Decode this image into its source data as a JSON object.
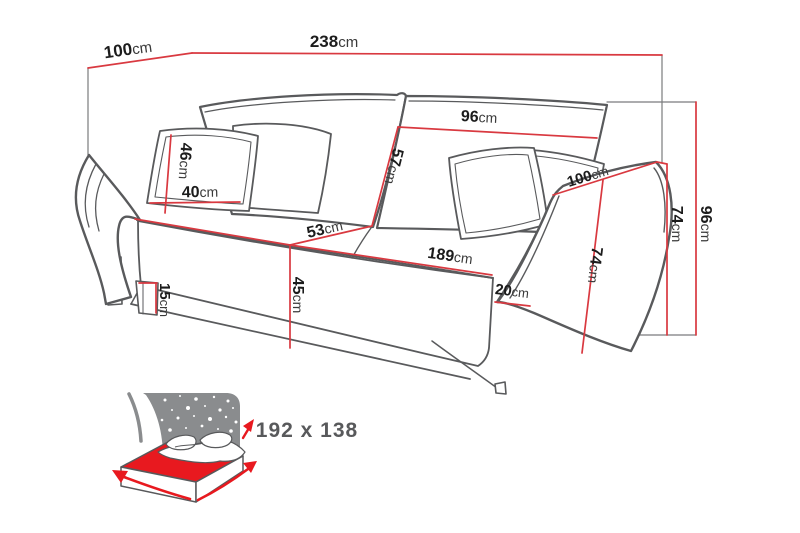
{
  "diagram": {
    "type": "sofa-bed dimension drawing",
    "unit_default": "cm",
    "dimensions": {
      "depth_top": {
        "value": "100",
        "unit": "cm",
        "meaning": "overall depth (top-left edge)"
      },
      "width_total": {
        "value": "238",
        "unit": "cm",
        "meaning": "overall width"
      },
      "back_cushion_width": {
        "value": "96",
        "unit": "cm",
        "meaning": "back cushion width"
      },
      "back_cushion_height": {
        "value": "57",
        "unit": "cm",
        "meaning": "back cushion height"
      },
      "pillow_height": {
        "value": "46",
        "unit": "cm",
        "meaning": "small pillow height"
      },
      "pillow_width": {
        "value": "40",
        "unit": "cm",
        "meaning": "small pillow width"
      },
      "seat_depth": {
        "value": "53",
        "unit": "cm",
        "meaning": "seat depth"
      },
      "seat_height": {
        "value": "45",
        "unit": "cm",
        "meaning": "seat height from floor"
      },
      "leg_height": {
        "value": "15",
        "unit": "cm",
        "meaning": "leg height"
      },
      "seat_width": {
        "value": "189",
        "unit": "cm",
        "meaning": "seat width between arms"
      },
      "arm_width": {
        "value": "20",
        "unit": "cm",
        "meaning": "armrest width"
      },
      "arm_depth": {
        "value": "100",
        "unit": "cm",
        "meaning": "armrest top depth"
      },
      "arm_height_front": {
        "value": "74",
        "unit": "cm",
        "meaning": "armrest height (front)"
      },
      "arm_height_back": {
        "value": "74",
        "unit": "cm",
        "meaning": "armrest height (back)"
      },
      "total_height": {
        "value": "96",
        "unit": "cm",
        "meaning": "total height"
      }
    },
    "bed_icon": {
      "size_label": "192 x 138",
      "meaning": "fold-out sleeping surface in cm"
    },
    "colors": {
      "dimension_line": "#d93940",
      "outline": "#595a5c",
      "projection_line": "#7a7b7d",
      "number_text": "#1c1c1c",
      "unit_text": "#3a3a3a",
      "icon_gray": "#8a8c8e",
      "icon_red": "#e8191f",
      "icon_text": "#58595b",
      "background": "#ffffff"
    }
  }
}
